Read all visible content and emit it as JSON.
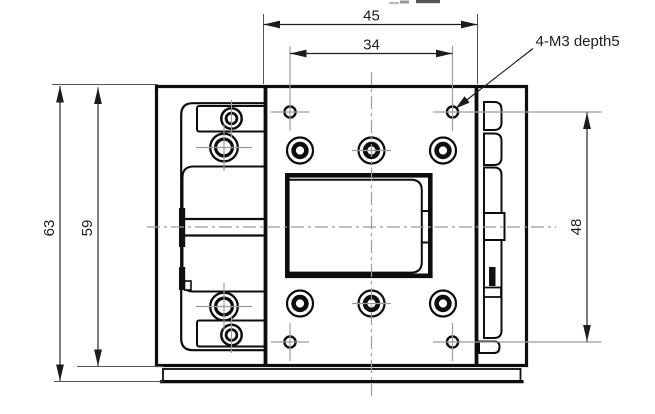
{
  "drawing": {
    "dimensions": {
      "table_width": "45",
      "hole_spacing_x": "34",
      "overall_height": "63",
      "body_height": "59",
      "hole_spacing_y": "48"
    },
    "notes": {
      "tapped_hole_callout": "4-M3 depth5"
    },
    "colors": {
      "line": "#0d0d0d",
      "centerline": "#9a9a9a",
      "dimension": "#1c1c1c",
      "background": "#ffffff"
    }
  }
}
